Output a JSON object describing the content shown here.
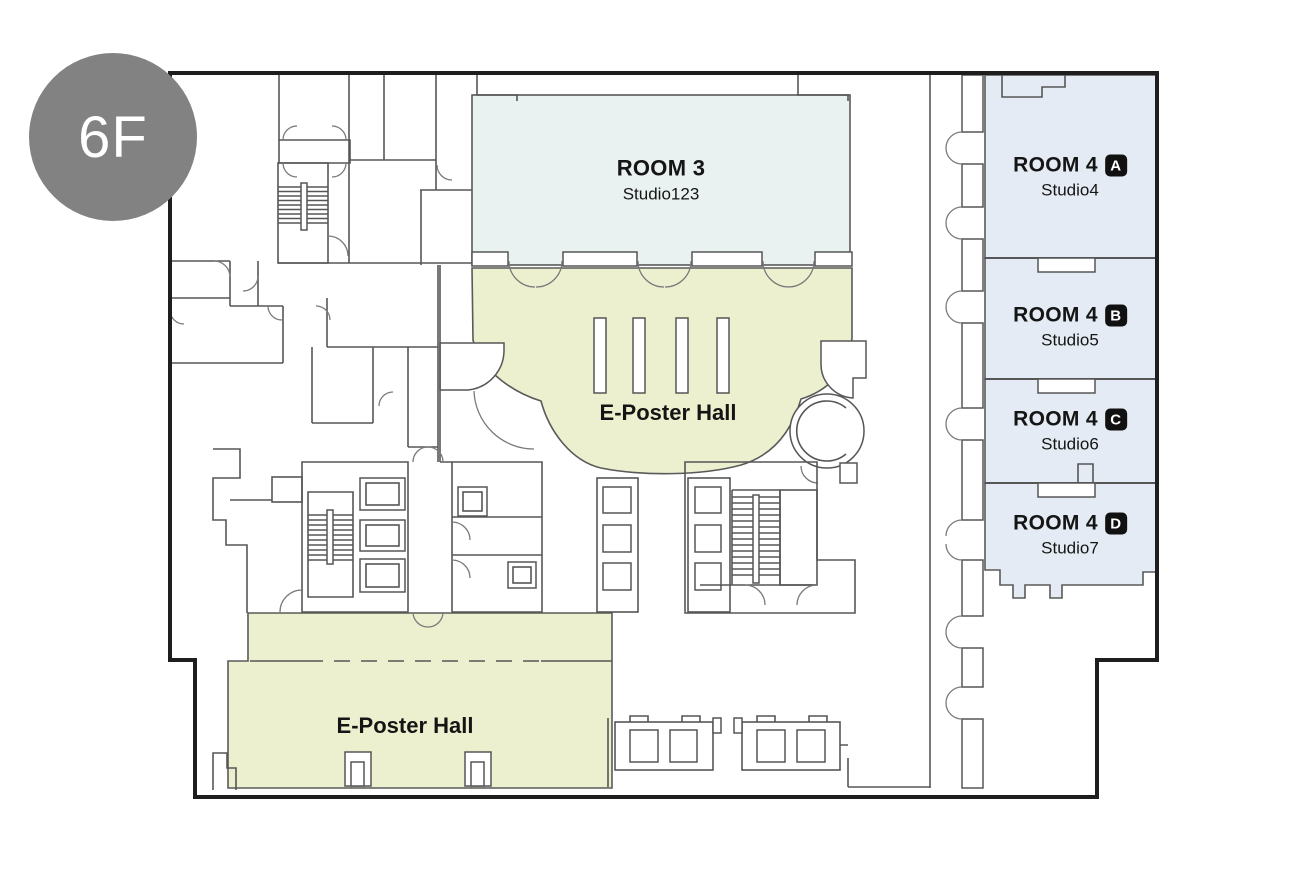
{
  "floor_badge": {
    "label": "6F"
  },
  "rooms": {
    "room3": {
      "name": "ROOM 3",
      "subtitle": "Studio123"
    },
    "room4a": {
      "name": "ROOM 4",
      "letter": "A",
      "subtitle": "Studio4"
    },
    "room4b": {
      "name": "ROOM 4",
      "letter": "B",
      "subtitle": "Studio5"
    },
    "room4c": {
      "name": "ROOM 4",
      "letter": "C",
      "subtitle": "Studio6"
    },
    "room4d": {
      "name": "ROOM 4",
      "letter": "D",
      "subtitle": "Studio7"
    },
    "eposter_center": {
      "name": "E-Poster Hall"
    },
    "eposter_south": {
      "name": "E-Poster Hall"
    }
  },
  "colors": {
    "room3_fill": "#e9f2f0",
    "room4_fill": "#e4ebf4",
    "eposter_fill": "#edf0cf",
    "badge_bg": "#828282",
    "badge_text": "#ffffff",
    "room_label_text": "#151515",
    "letter_badge_bg": "#111111",
    "wall": "#565656",
    "outer_wall": "#1e1e1e"
  }
}
